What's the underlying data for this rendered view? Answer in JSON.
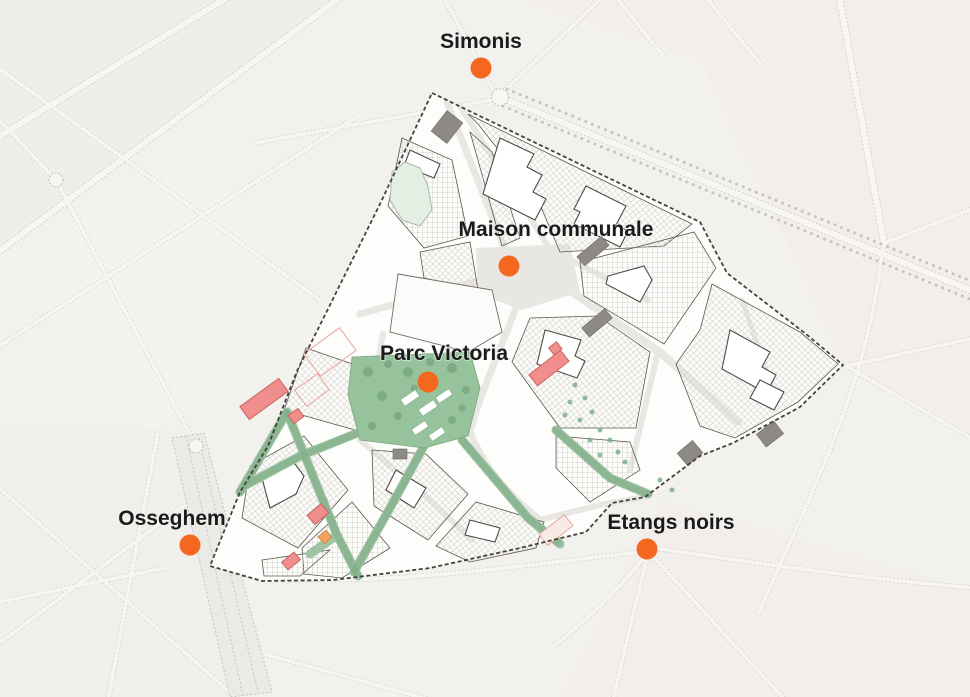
{
  "map": {
    "kind": "urban-district-plan",
    "marker_color": "#F4671F",
    "label_color": "#1B1B1B",
    "colors": {
      "background": "#F3F1EE",
      "district_fill": "#FDFDFB",
      "district_boundary": "#45413C",
      "park_green": "#96C29C",
      "corridor_green": "#9FC4A4",
      "pond_green": "#E4EFE4",
      "highlight_building_red": "#EF8E8C",
      "highlight_building_orange": "#F0A35E",
      "dark_building_gray": "#8D8984"
    },
    "stations": [
      {
        "name": "Simonis",
        "x": 481,
        "y": 68,
        "lx": 481,
        "ly": 48
      },
      {
        "name": "Maison communale",
        "x": 509,
        "y": 266,
        "lx": 556,
        "ly": 236
      },
      {
        "name": "Parc Victoria",
        "x": 428,
        "y": 382,
        "lx": 444,
        "ly": 360
      },
      {
        "name": "Osseghem",
        "x": 190,
        "y": 545,
        "lx": 172,
        "ly": 525
      },
      {
        "name": "Etangs noirs",
        "x": 647,
        "y": 549,
        "lx": 671,
        "ly": 529
      }
    ]
  }
}
